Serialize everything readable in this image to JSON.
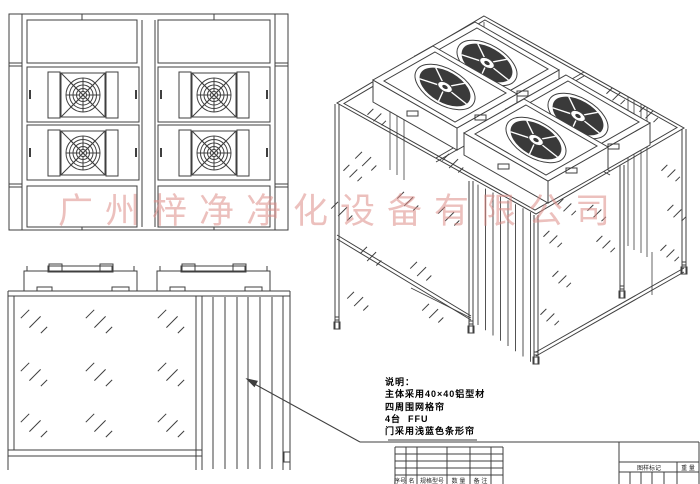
{
  "watermark": {
    "text": "广州梓净净化设备有限公司",
    "color": "#dd8d88"
  },
  "notes": {
    "lines": [
      "说明：",
      "主体采用40×40铝型材",
      "四周围网格帘",
      "4台  FFU",
      "门采用浅蓝色条形帘"
    ]
  },
  "parts_table": {
    "headers": [
      "序号",
      "名称",
      "规格型号",
      "数 量",
      "备 注"
    ]
  },
  "title_block": {
    "mark_label": "图样标记",
    "weight_label": "重 量"
  },
  "drawing": {
    "line_color": "#3f3f3f",
    "fan_dark": "#3a3a3a"
  }
}
